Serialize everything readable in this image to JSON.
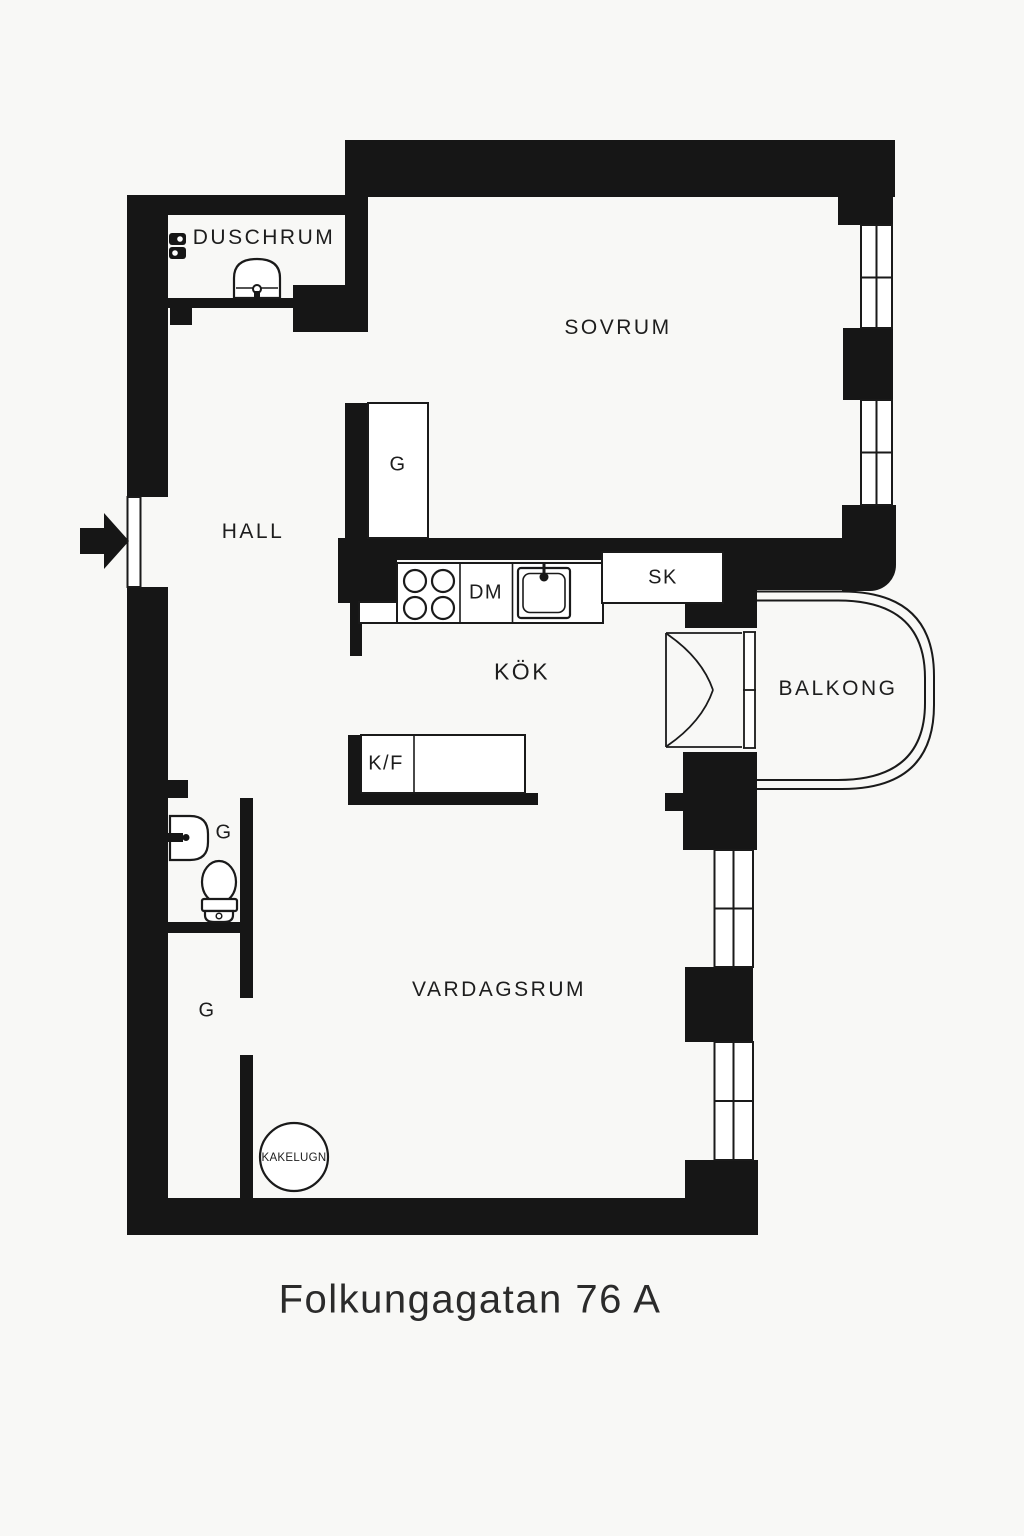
{
  "title": "Folkungagatan 76 A",
  "rooms": {
    "duschrum": "DUSCHRUM",
    "sovrum": "SOVRUM",
    "hall": "HALL",
    "kok": "KÖK",
    "balkong": "BALKONG",
    "vardagsrum": "VARDAGSRUM"
  },
  "fixtures": {
    "wardrobe": "G",
    "dishwasher": "DM",
    "cabinet": "SK",
    "fridge_freezer": "K/F",
    "tiled_stove": "KAKELUGN"
  },
  "colors": {
    "wall": "#161616",
    "background": "#f8f8f6",
    "line": "#1a1a1a",
    "text": "#1d1d1d"
  }
}
